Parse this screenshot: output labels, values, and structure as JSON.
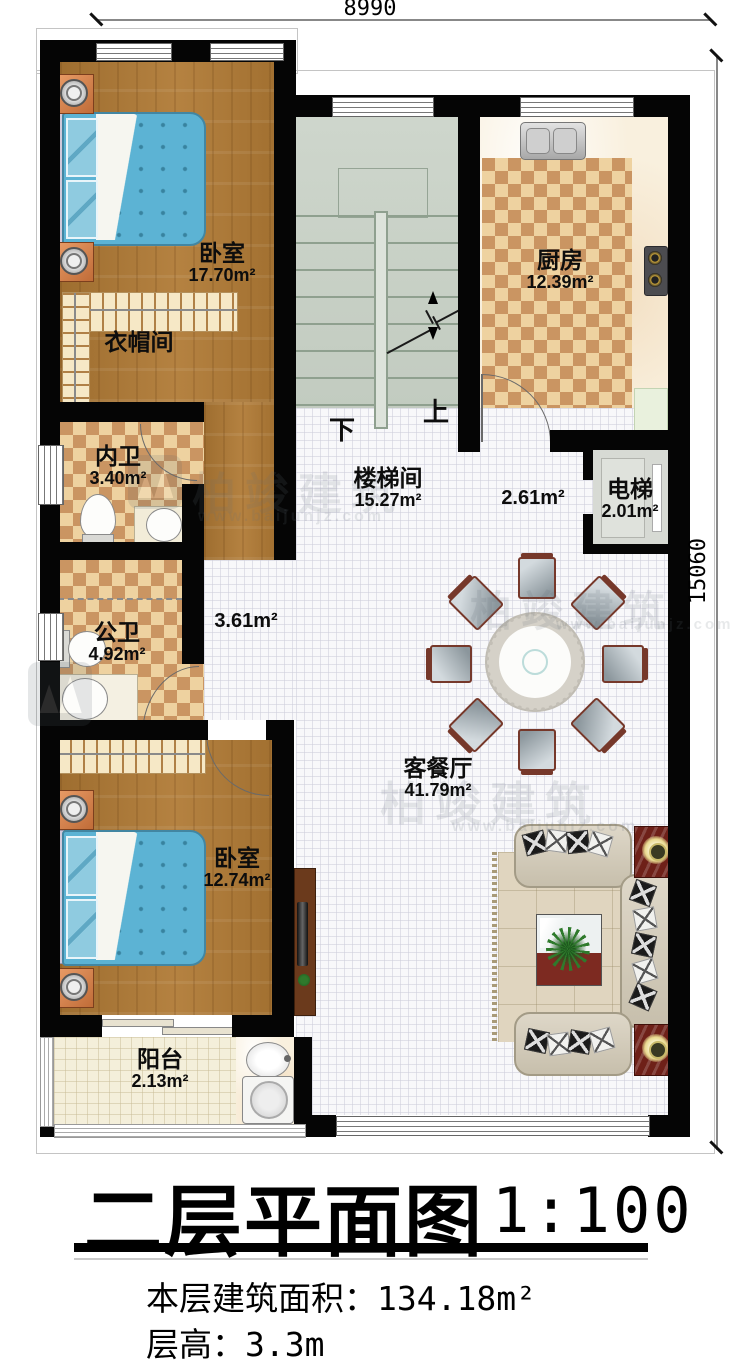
{
  "dimensions": {
    "top": "8990",
    "right": "15060"
  },
  "stairs": {
    "down": "下",
    "up": "上"
  },
  "rooms": {
    "bedroom1": {
      "name": "卧室",
      "area": "17.70m²"
    },
    "cloakroom": {
      "name": "衣帽间"
    },
    "inner_bath": {
      "name": "内卫",
      "area": "3.40m²"
    },
    "public_bath": {
      "name": "公卫",
      "area": "4.92m²"
    },
    "stairwell": {
      "name": "楼梯间",
      "area": "15.27m²"
    },
    "kitchen": {
      "name": "厨房",
      "area": "12.39m²"
    },
    "elevator": {
      "name": "电梯",
      "area": "2.01m²"
    },
    "living_dining": {
      "name": "客餐厅",
      "area": "41.79m²"
    },
    "bedroom2": {
      "name": "卧室",
      "area": "12.74m²"
    },
    "balcony": {
      "name": "阳台",
      "area": "2.13m²"
    },
    "hall_upper": {
      "area": "2.61m²"
    },
    "hall_lower": {
      "area": "3.61m²"
    }
  },
  "title": {
    "main": "二层平面图",
    "scale": "1:100"
  },
  "info": {
    "area_label": "本层建筑面积：",
    "area_value": "134.18m²",
    "height_label": "层高：",
    "height_value": "3.3m"
  },
  "watermark": {
    "brand": "柏竣建筑",
    "url": "www.baijunjz.com"
  },
  "colors": {
    "wall": "#050505",
    "wood": "#b07a35",
    "tile_light": "#eed2a0",
    "tile_dark": "#ca9562",
    "stair": "#c8d1c6",
    "bed": "#5cb3d4",
    "accent_red": "#6e2018"
  }
}
